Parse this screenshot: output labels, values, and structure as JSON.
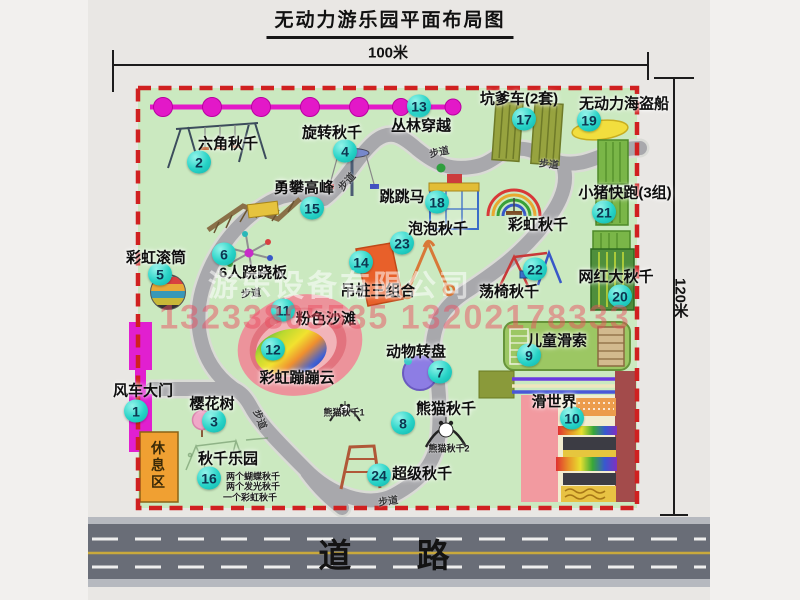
{
  "title": "无动力游乐园平面布局图",
  "scale": {
    "width": "100米",
    "height": "120米"
  },
  "road": {
    "label": "道 路"
  },
  "rest_area": {
    "label": "休息区"
  },
  "watermarks": {
    "company": "游乐设备有限公司",
    "phone": "13233805535 13202178333"
  },
  "walkway_label": "步道",
  "colors": {
    "map_bg": "#cbe9c0",
    "border": "#d02020",
    "bubble": "#27d3c7",
    "zipline": "#e318c8",
    "rest_area": "#f0a032",
    "road": "#696d77",
    "gate": "#e11fd0"
  },
  "map": {
    "attractions": [
      {
        "n": 1,
        "name": "风车大门",
        "bx": 136,
        "by": 411,
        "lx": 143,
        "ly": 390
      },
      {
        "n": 2,
        "name": "六角秋千",
        "bx": 199,
        "by": 162,
        "lx": 228,
        "ly": 143
      },
      {
        "n": 3,
        "name": "樱花树",
        "bx": 214,
        "by": 421,
        "lx": 212,
        "ly": 403
      },
      {
        "n": 4,
        "name": "旋转秋千",
        "bx": 345,
        "by": 151,
        "lx": 332,
        "ly": 132
      },
      {
        "n": 5,
        "name": "彩虹滚筒",
        "bx": 160,
        "by": 274,
        "lx": 156,
        "ly": 257
      },
      {
        "n": 6,
        "name": "6人跷跷板",
        "bx": 224,
        "by": 254,
        "lx": 253,
        "ly": 272
      },
      {
        "n": 7,
        "name": "动物转盘",
        "bx": 440,
        "by": 372,
        "lx": 416,
        "ly": 351
      },
      {
        "n": 8,
        "name": "熊猫秋千",
        "bx": 403,
        "by": 423,
        "lx": 446,
        "ly": 408,
        "subs": [
          {
            "t": "熊猫秋千1",
            "x": 344,
            "y": 412
          },
          {
            "t": "熊猫秋千2",
            "x": 449,
            "y": 448
          }
        ]
      },
      {
        "n": 9,
        "name": "儿童滑索",
        "bx": 529,
        "by": 355,
        "lx": 557,
        "ly": 340
      },
      {
        "n": 10,
        "name": "滑世界",
        "bx": 572,
        "by": 418,
        "lx": 554,
        "ly": 401
      },
      {
        "n": 11,
        "name": "粉色沙滩",
        "bx": 283,
        "by": 310,
        "lx": 326,
        "ly": 318
      },
      {
        "n": 12,
        "name": "彩虹蹦蹦云",
        "bx": 273,
        "by": 349,
        "lx": 297,
        "ly": 377
      },
      {
        "n": 13,
        "name": "丛林穿越",
        "bx": 419,
        "by": 106,
        "lx": 421,
        "ly": 125
      },
      {
        "n": 14,
        "name": "吊桩三组合",
        "bx": 361,
        "by": 262,
        "lx": 378,
        "ly": 290
      },
      {
        "n": 15,
        "name": "勇攀高峰",
        "bx": 312,
        "by": 208,
        "lx": 304,
        "ly": 187
      },
      {
        "n": 16,
        "name": "秋千乐园",
        "bx": 209,
        "by": 478,
        "lx": 228,
        "ly": 458,
        "subs": [
          {
            "t": "两个蝴蝶秋千",
            "x": 253,
            "y": 476
          },
          {
            "t": "两个发光秋千",
            "x": 253,
            "y": 486
          },
          {
            "t": "一个彩虹秋千",
            "x": 250,
            "y": 497
          }
        ]
      },
      {
        "n": 17,
        "name": "坑爹车(2套)",
        "bx": 524,
        "by": 119,
        "lx": 519,
        "ly": 98
      },
      {
        "n": 18,
        "name": "跳跳马",
        "bx": 437,
        "by": 202,
        "lx": 402,
        "ly": 196
      },
      {
        "n": 19,
        "name": "无动力海盗船",
        "bx": 589,
        "by": 120,
        "lx": 624,
        "ly": 103
      },
      {
        "n": 20,
        "name": "网红大秋千",
        "bx": 620,
        "by": 296,
        "lx": 616,
        "ly": 276
      },
      {
        "n": 21,
        "name": "小猪快跑(3组)",
        "bx": 604,
        "by": 212,
        "lx": 625,
        "ly": 192
      },
      {
        "n": 22,
        "name": "荡椅秋千",
        "bx": 535,
        "by": 269,
        "lx": 509,
        "ly": 291
      },
      {
        "n": 23,
        "name": "泡泡秋千",
        "bx": 402,
        "by": 243,
        "lx": 438,
        "ly": 228
      },
      {
        "n": 24,
        "name": "超级秋千",
        "bx": 379,
        "by": 475,
        "lx": 422,
        "ly": 473
      },
      {
        "n": null,
        "name": "彩虹秋千",
        "lx": 538,
        "ly": 224
      }
    ],
    "path_labels": [
      {
        "x": 251,
        "y": 292,
        "rot": -5
      },
      {
        "x": 346,
        "y": 181,
        "rot": -48
      },
      {
        "x": 439,
        "y": 151,
        "rot": -12
      },
      {
        "x": 549,
        "y": 163,
        "rot": 6
      },
      {
        "x": 261,
        "y": 419,
        "rot": 68
      },
      {
        "x": 388,
        "y": 500,
        "rot": -8
      }
    ]
  }
}
